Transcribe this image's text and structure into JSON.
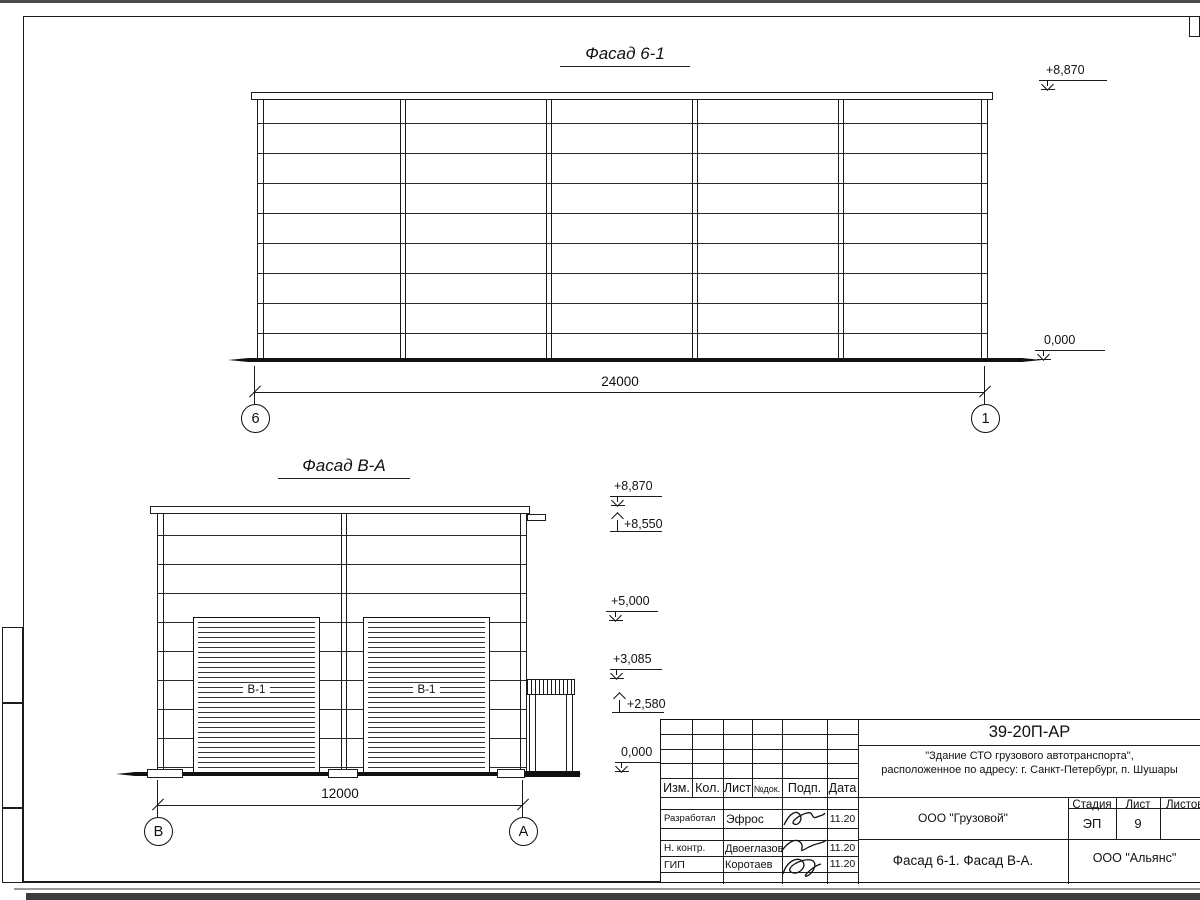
{
  "sheet": {
    "facade1": {
      "title": "Фасад 6-1",
      "dim": "24000",
      "axis_left": "6",
      "axis_right": "1",
      "level_top": "+8,870",
      "level_bottom": "0,000"
    },
    "facade2": {
      "title": "Фасад В-А",
      "dim": "12000",
      "axis_left": "В",
      "axis_right": "А",
      "door_label": "В-1",
      "levels": {
        "l8870": "+8,870",
        "l8550": "+8,550",
        "l5000": "+5,000",
        "l3085": "+3,085",
        "l2580": "+2,580",
        "l0": "0,000"
      }
    }
  },
  "titleblock": {
    "doc_number": "39-20П-АР",
    "project_line1": "\"Здание СТО грузового автотранспорта\",",
    "project_line2": "расположенное по адресу: г. Санкт-Петербург, п. Шушары",
    "cols": {
      "izm": "Изм.",
      "kol": "Кол.",
      "list": "Лист",
      "ndok": "№док.",
      "podp": "Подп.",
      "data": "Дата"
    },
    "rows": {
      "r1_role": "Разработал",
      "r1_name": "Эфрос",
      "r1_date": "11.20",
      "r2_role": "Н. контр.",
      "r2_name": "Двоеглазов",
      "r2_date": "11.20",
      "r3_role": "ГИП",
      "r3_name": "Коротаев",
      "r3_date": "11.20"
    },
    "org": "ООО \"Грузовой\"",
    "stage_label": "Стадия",
    "sheet_label": "Лист",
    "sheets_label": "Листов",
    "stage": "ЭП",
    "sheet_num": "9",
    "sheet_title": "Фасад 6-1. Фасад В-А.",
    "company": "ООО \"Альянс\""
  }
}
